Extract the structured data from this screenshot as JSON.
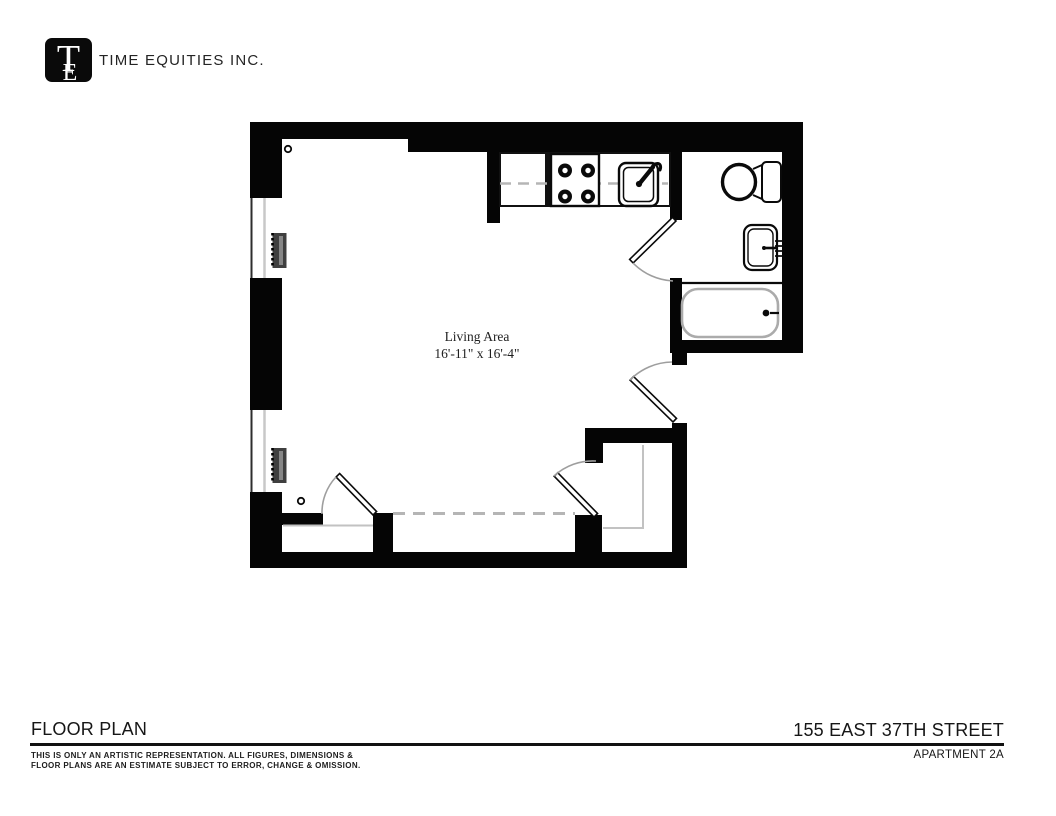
{
  "header": {
    "logo_letter_t": "T",
    "logo_letter_e": "E",
    "company": "TIME EQUITIES INC."
  },
  "plan": {
    "room_label": "Living Area",
    "room_dimensions": "16'-11\" x 16'-4\"",
    "fixtures": [
      "stove",
      "kitchen-sink",
      "toilet",
      "bathroom-sink",
      "bathtub",
      "radiator",
      "window",
      "closet",
      "entry-door"
    ]
  },
  "footer": {
    "left_title": "FLOOR PLAN",
    "right_title": "155 EAST 37TH STREET",
    "disclaimer_line1": "THIS IS ONLY AN ARTISTIC REPRESENTATION. ALL FIGURES, DIMENSIONS &",
    "disclaimer_line2": "FLOOR PLANS ARE AN ESTIMATE SUBJECT TO ERROR, CHANGE & OMISSION.",
    "apartment": "APARTMENT 2A"
  },
  "colors": {
    "wall": "#050505",
    "door_arc": "#9e9e9e",
    "dashed_line": "#b5b5b5",
    "window_glass": "#c8c8c8",
    "bathtub_outline": "#ababab",
    "radiator_fill": "#3f3f3f"
  }
}
